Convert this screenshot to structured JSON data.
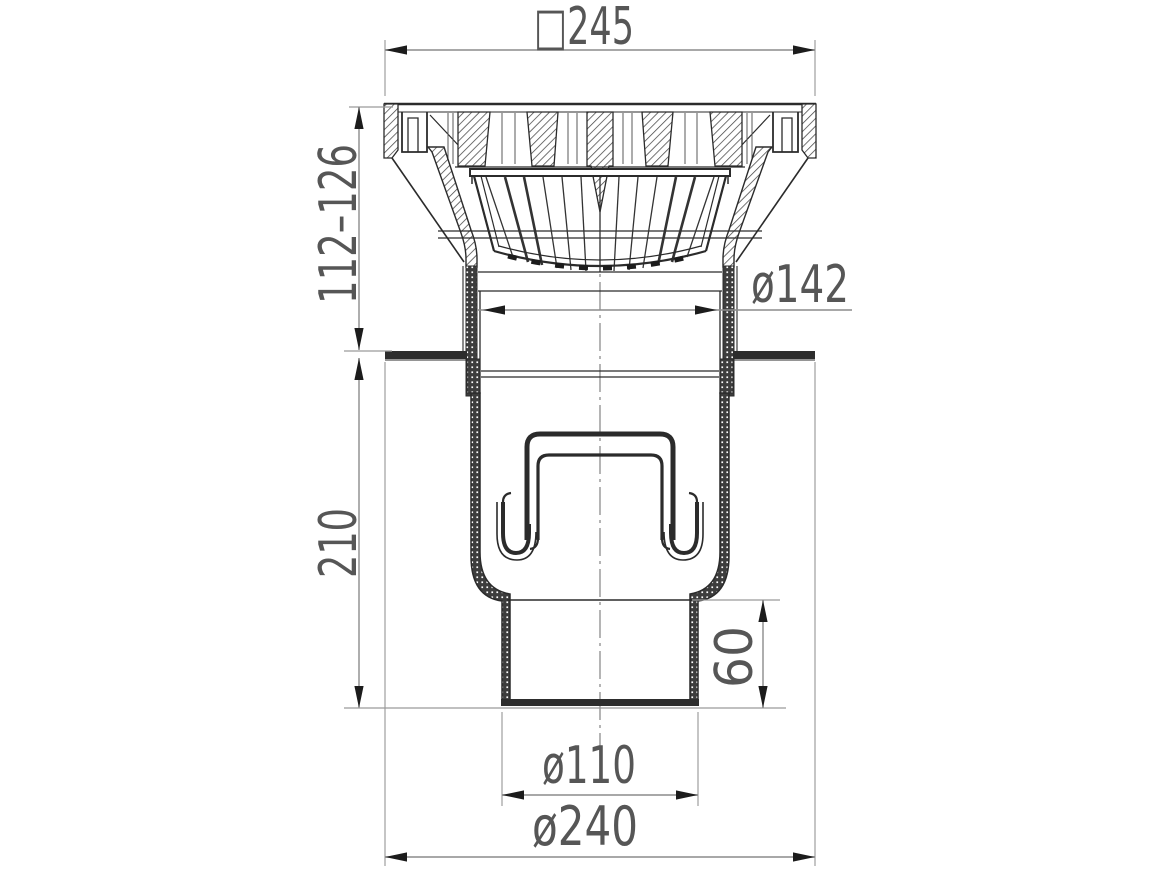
{
  "drawing": {
    "kind": "drain-cross-section",
    "labels": {
      "top_width": "□245",
      "height_range": "112–126",
      "upper_diameter": "ø142",
      "body_height": "210",
      "outlet_stub_height": "60",
      "outlet_diameter": "ø110",
      "flange_diameter": "ø240"
    },
    "colors": {
      "background": "#ffffff",
      "outline": "#2b2b2b",
      "dark_fill": "#2d2d2d",
      "dimension_line": "#8c8c8c",
      "extension_line": "#9a9a9a",
      "arrow": "#1c1c1c",
      "label_text": "#565656"
    }
  }
}
